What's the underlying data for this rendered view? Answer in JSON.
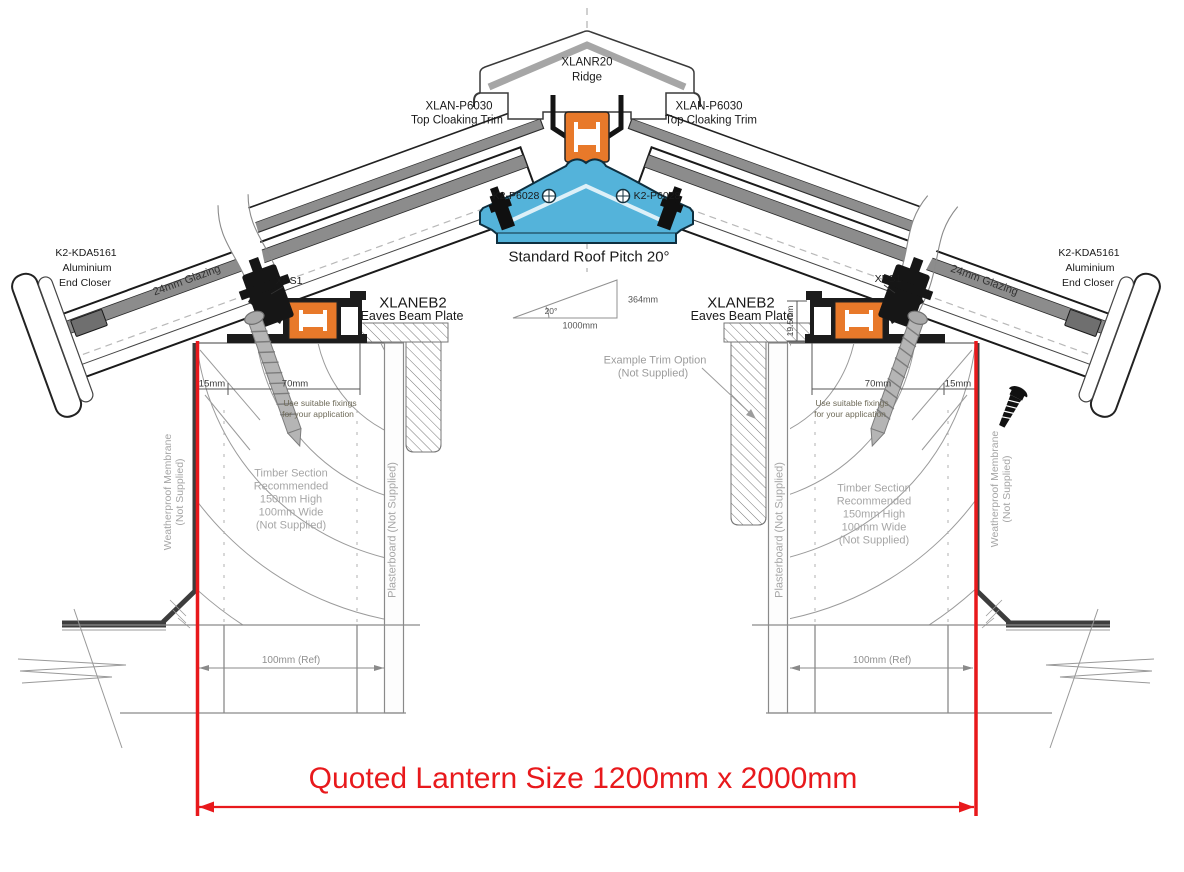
{
  "colors": {
    "accent_red": "#e8191c",
    "profile_orange": "#e8792a",
    "profile_blue": "#54b3da",
    "hatch_gray": "#777777",
    "grain_gray": "#9b9b9b"
  },
  "labels": {
    "ridge_code": "XLANR20",
    "ridge": "Ridge",
    "cloaking_code": "XLAN-P6030",
    "cloaking": "Top Cloaking Trim",
    "ridge_bolt_code": "K2-P6028",
    "pitch": "Standard Roof Pitch 20°",
    "pitch_angle": "20°",
    "pitch_rise": "364mm",
    "pitch_run": "1000mm",
    "eaves_code": "XLANEB2",
    "eaves": "Eaves Beam Plate",
    "gasket_code": "XPS1",
    "end_closer_code": "K2-KDA5161",
    "end_closer_l2": "Aluminium",
    "end_closer_l3": "End Closer",
    "glazing": "24mm Glazing",
    "dim_15": "15mm",
    "dim_70": "70mm",
    "dim_ref": "100mm (Ref)",
    "dim_beam_height": "19.5mm",
    "fixings_l1": "Use suitable fixings",
    "fixings_l2": "for your application",
    "timber_l1": "Timber Section",
    "timber_l2": "Recommended",
    "timber_l3": "150mm High",
    "timber_l4": "100mm Wide",
    "timber_l5": "(Not Supplied)",
    "plasterboard": "Plasterboard (Not Supplied)",
    "membrane_l1": "Weatherproof Membrane",
    "membrane_l2": "(Not Supplied)",
    "trim_option_l1": "Example Trim Option",
    "trim_option_l2": "(Not Supplied)",
    "quoted_size": "Quoted Lantern Size 1200mm x 2000mm"
  }
}
